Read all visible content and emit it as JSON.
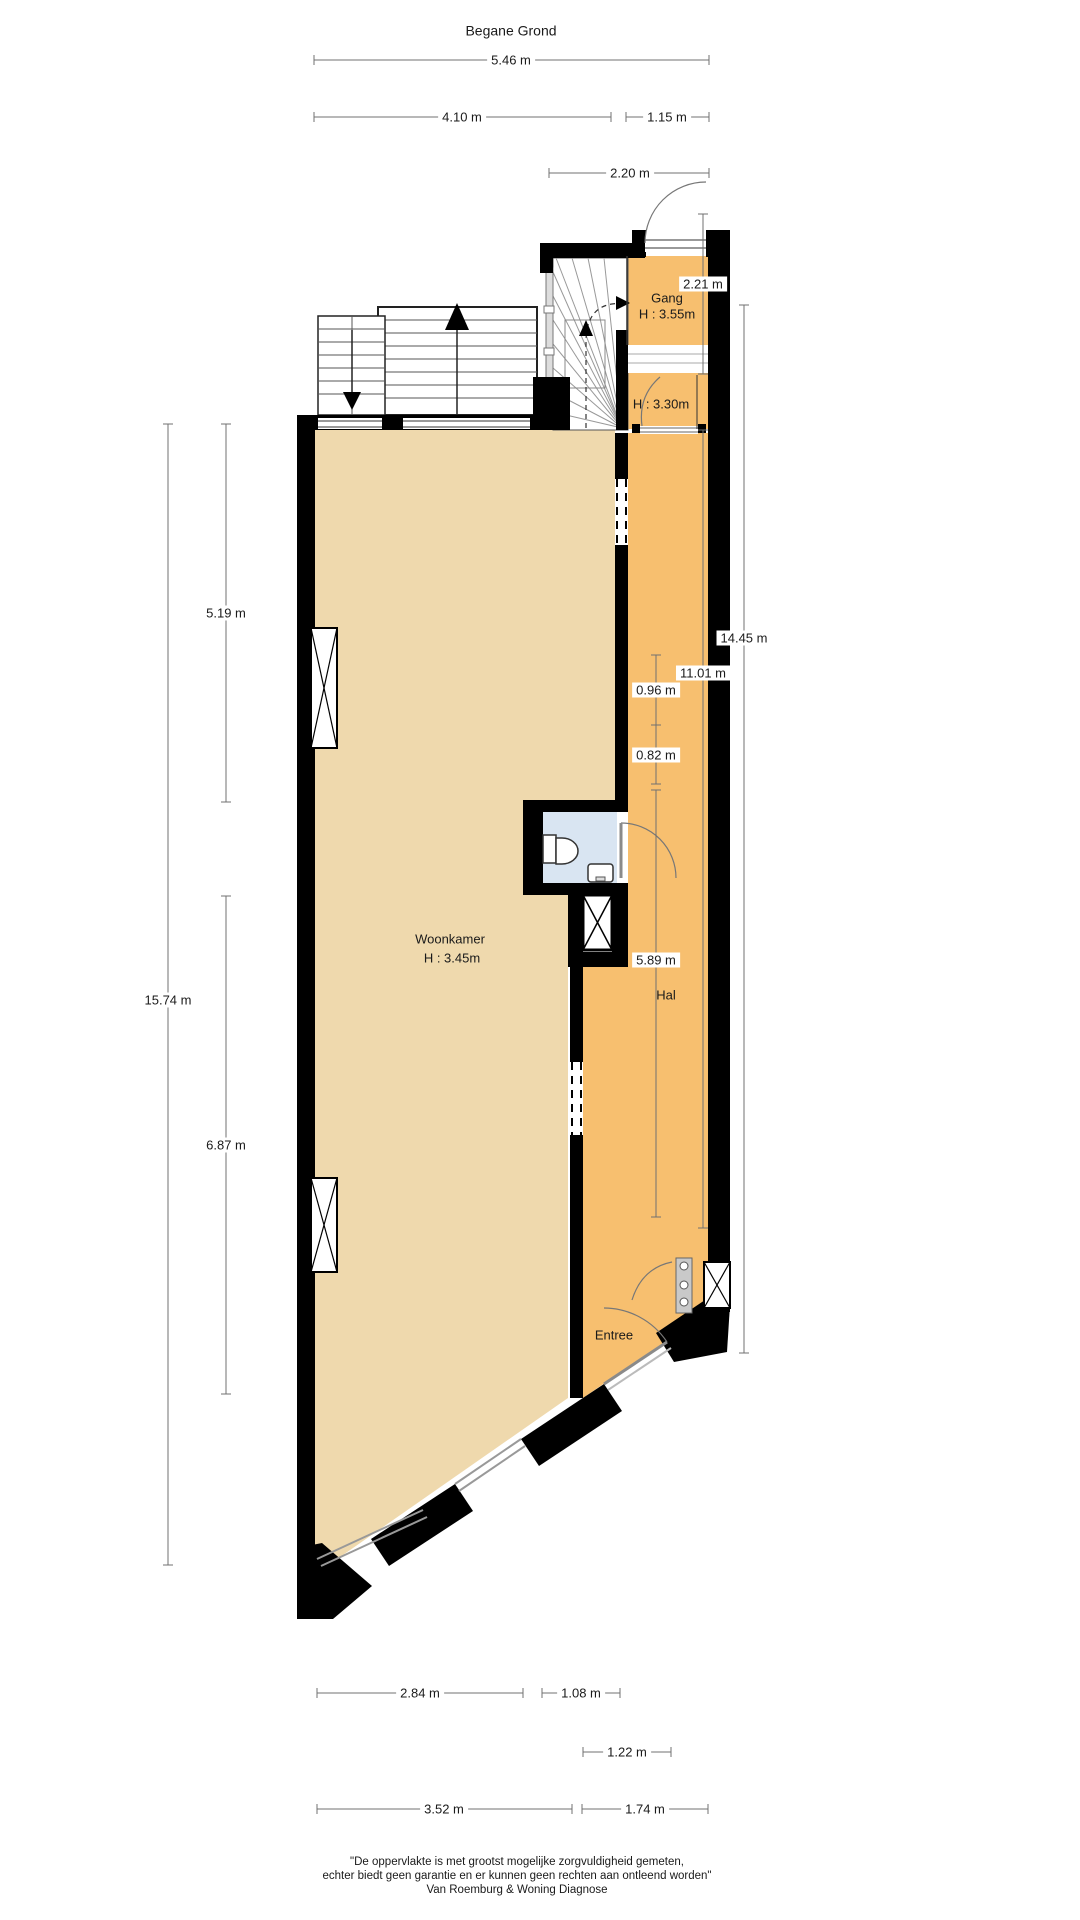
{
  "title": "Begane Grond",
  "rooms": {
    "gang": {
      "name": "Gang",
      "height": "H : 3.55m"
    },
    "landing": {
      "height": "H : 3.30m"
    },
    "living": {
      "name": "Woonkamer",
      "height": "H : 3.45m"
    },
    "hall": {
      "name": "Hal"
    },
    "entry": {
      "name": "Entree"
    }
  },
  "dimensions": {
    "top": {
      "d546": "5.46 m",
      "d410": "4.10 m",
      "d115": "1.15 m",
      "d220": "2.20 m"
    },
    "left": {
      "d519": "5.19 m",
      "d1574": "15.74 m",
      "d687": "6.87 m"
    },
    "right": {
      "d221": "2.21 m",
      "d1445": "14.45 m",
      "d1101": "11.01 m",
      "d096": "0.96 m",
      "d082": "0.82 m",
      "d589": "5.89 m"
    },
    "bottom": {
      "d284": "2.84 m",
      "d108": "1.08 m",
      "d122": "1.22 m",
      "d352": "3.52 m",
      "d174": "1.74 m"
    }
  },
  "footer": {
    "line1": "\"De oppervlakte is met grootst mogelijke zorgvuldigheid gemeten,",
    "line2": "echter biedt geen garantie en er kunnen geen rechten aan ontleend worden\"",
    "line3": "Van Roemburg & Woning Diagnose"
  },
  "colors": {
    "floor_living": "#EFD9AD",
    "floor_hall": "#F7BF6F",
    "toilet_floor": "#D9E5F2",
    "wall": "#000000",
    "window_glass": "#999999",
    "dimension_line": "#707070"
  }
}
